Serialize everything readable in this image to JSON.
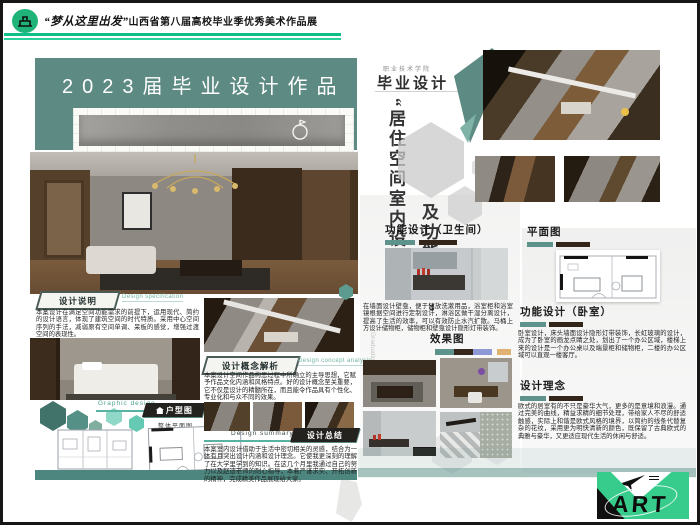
{
  "header": {
    "brand_quote": "“梦从这里出发”",
    "brand_rest": "山西省第八届高校毕业季优秀美术作品展"
  },
  "left": {
    "title": "2023届毕业设计作品",
    "note_badge": "设计说明",
    "note_en": "Design specification",
    "note_text": "本案设计在满足空间功能需求的前提下，运用现代、简约的设计语言，体现了建筑空间的时代特质。采用中心空间序列的手法，减弱原有空间单调、呆板的感觉，增强过渡空间的表现性。",
    "concept_badge": "设计概念解析",
    "concept_en": "Design concept analysis",
    "concept_text": "本案设计空间作品构思过程中所确立的主导思想，它赋予作品文化内涵和风格特点。好的设计概念至关重要，它不仅是设计的精髓所在，而且能令作品具有个性化、专业化和与众不同的效果。",
    "graphic_label": "Graphic design",
    "plan_badge": "户型图",
    "plan_caption": "整体平面图",
    "summary_en": "Design summary",
    "summary_badge": "设计总结",
    "summary_text": "本案室内设计借助于生活中密切相关的灵感，结合为一体有且突出设计内涵和设计理念。它使我更深刻的理解了在大学里学到的知识。在这几个月里我通过自己的努力以及赵迪老师的耐心指导，本着严谨求实、开拓创新的精神，完成精美作品展现给大家。"
  },
  "right": {
    "school": "职业技术学院",
    "program": "毕业设计",
    "vtitle_1": "“居住空间室内设计",
    "vtitle_2": "及功能分析”",
    "vtitle_en": "Graduation Design",
    "bath_heading": "功能设计（卫生间）",
    "bath_text": "在墙面设计壁龛，便于储放洗漱用品，浴室柜和浴室镜根据空间进行定制设计，淋浴区做干湿分离设计，提高了生活的效率，可以有效防止水汽扩散。马桶上方设计储物柜，储物柜和壁龛设计隐形灯带装饰。",
    "effect_heading": "效果图",
    "plan_heading": "平面图",
    "bed_heading": "功能设计（卧室）",
    "bed_text": "卧室设计，床头墙面设计隐形灯带装饰，长虹玻璃的设计，成为了卧室的画龙点睛之处，划出了一个办公区域，楼梯上来的设计是一个办公桌以及端景柜和储物柜，二楼的办公区域可以直观一楼客厅。",
    "idea_heading": "设计理念",
    "idea_text": "欧式的居室有的不只是豪华大气，更多的是意境和浪漫。通过完美的曲线，精益求精的细节处理，带给家人不尽的舒适触感，实际上和谐是欧式风格的境界，以简约的线条代替复杂的花纹，采用更为明快清新的颜色，既保留了古典欧式的典雅与豪华，又更适应现代生活的休闲与舒适。",
    "art_label": "ART"
  },
  "palette": {
    "teal_panel": "#5d8a82",
    "header_green": "#0fbf87",
    "logo_green": "#38cc8c",
    "effect_swatches": [
      "#5e938c",
      "#38271c",
      "#8e9ad8",
      "#dfb272"
    ]
  }
}
